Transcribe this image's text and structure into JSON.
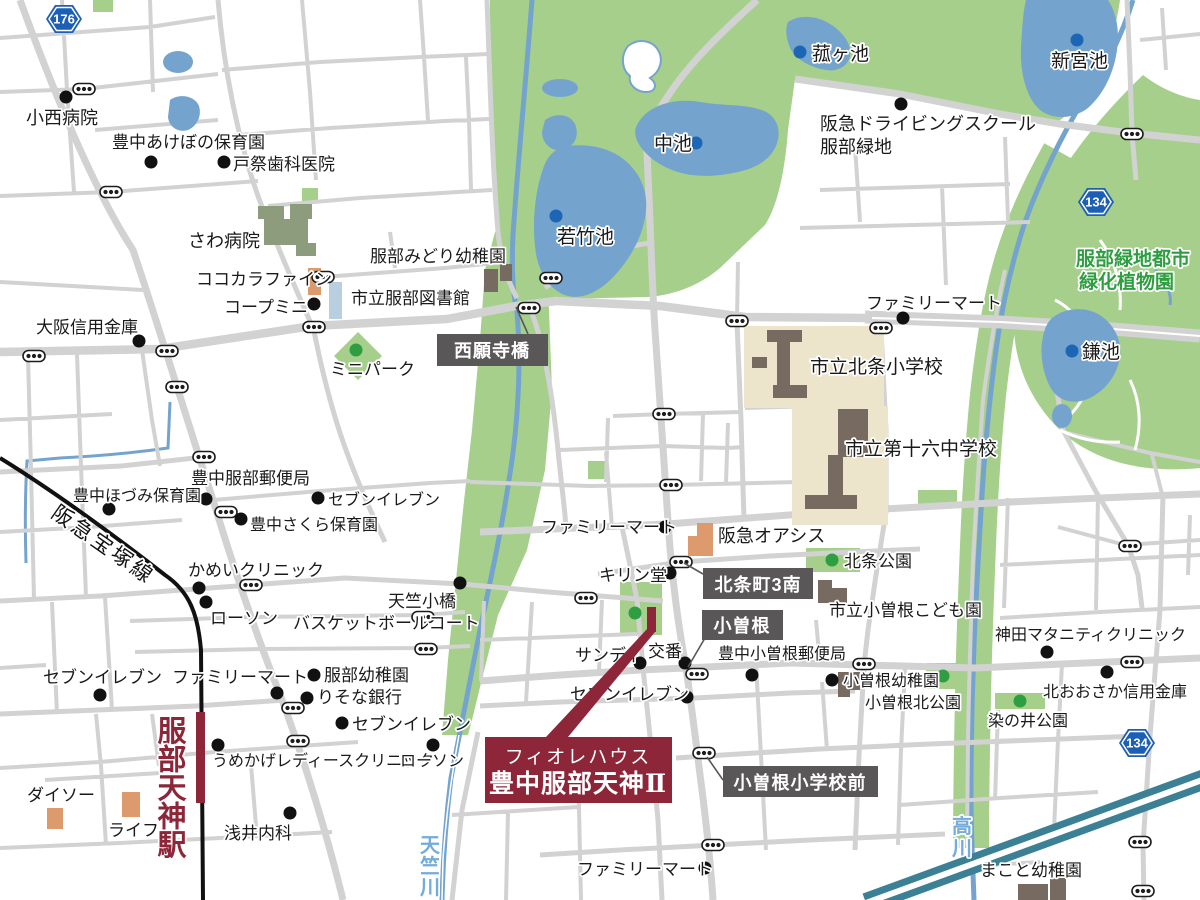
{
  "map": {
    "site": {
      "line1": "フィオレハウス",
      "line2": "豊中服部天神Ⅱ"
    },
    "station": {
      "name": "服部天神駅"
    },
    "railway": {
      "name": "阪急宝塚線"
    },
    "rivers": [
      {
        "name": "天竺川"
      },
      {
        "name": "高川"
      }
    ],
    "garden": {
      "line1": "服部緑地都市",
      "line2": "緑化植物園"
    },
    "callouts": [
      {
        "t": "西願寺橋"
      },
      {
        "t": "北条町3南"
      },
      {
        "t": "小曽根"
      },
      {
        "t": "小曽根小学校前"
      }
    ],
    "route_badges": [
      {
        "n": "176",
        "x": 64,
        "y": 19
      },
      {
        "n": "134",
        "x": 1096,
        "y": 202
      },
      {
        "n": "134",
        "x": 1137,
        "y": 743
      }
    ],
    "colors": {
      "accent_maroon": "#8c2638",
      "callout_gray": "#595757",
      "park_green": "#a6cf8c",
      "water_blue": "#74a4ce",
      "road_gray": "#d2d2d2",
      "badge_blue": "#1d5fb4",
      "garden_text_green": "#2f9e41",
      "river_text_blue": "#74abd8"
    },
    "labels": [
      {
        "t": "小西病院",
        "x": 26,
        "y": 124,
        "s": 18
      },
      {
        "t": "豊中あけぼの保育園",
        "x": 112,
        "y": 148
      },
      {
        "t": "戸祭歯科医院",
        "x": 233,
        "y": 170
      },
      {
        "t": "さわ病院",
        "x": 188,
        "y": 247,
        "s": 18
      },
      {
        "t": "ココカラファイン",
        "x": 196,
        "y": 285
      },
      {
        "t": "コープミニ",
        "x": 224,
        "y": 313
      },
      {
        "t": "市立服部図書館",
        "x": 351,
        "y": 304
      },
      {
        "t": "大阪信用金庫",
        "x": 36,
        "y": 333
      },
      {
        "t": "ミニパーク",
        "x": 330,
        "y": 375
      },
      {
        "t": "服部みどり幼稚園",
        "x": 370,
        "y": 262
      },
      {
        "t": "豊中服部郵便局",
        "x": 191,
        "y": 484
      },
      {
        "t": "豊中ほづみ保育園",
        "x": 73,
        "y": 501,
        "s": 16
      },
      {
        "t": "セブンイレブン",
        "x": 328,
        "y": 505,
        "s": 16
      },
      {
        "t": "豊中さくら保育園",
        "x": 250,
        "y": 530,
        "s": 16
      },
      {
        "t": "かめいクリニック",
        "x": 188,
        "y": 576
      },
      {
        "t": "ローソン",
        "x": 210,
        "y": 624
      },
      {
        "t": "天竺小橋",
        "x": 388,
        "y": 607
      },
      {
        "t": "バスケットボールコート",
        "x": 293,
        "y": 629
      },
      {
        "t": "セブンイレブン",
        "x": 43,
        "y": 683
      },
      {
        "t": "ファミリーマート",
        "x": 172,
        "y": 683
      },
      {
        "t": "服部幼稚園",
        "x": 324,
        "y": 681
      },
      {
        "t": "りそな銀行",
        "x": 317,
        "y": 703
      },
      {
        "t": "セブンイレブン",
        "x": 352,
        "y": 730
      },
      {
        "t": "うめかげレディースクリニック",
        "x": 212,
        "y": 766,
        "s": 16
      },
      {
        "t": "ローソン",
        "x": 400,
        "y": 766,
        "s": 16
      },
      {
        "t": "ダイソー",
        "x": 27,
        "y": 801
      },
      {
        "t": "ライフ",
        "x": 108,
        "y": 836
      },
      {
        "t": "浅井内科",
        "x": 224,
        "y": 839
      },
      {
        "t": "サンディ",
        "x": 575,
        "y": 661
      },
      {
        "t": "交番",
        "x": 648,
        "y": 657
      },
      {
        "t": "セブンイレブン",
        "x": 570,
        "y": 700
      },
      {
        "t": "キリン堂",
        "x": 599,
        "y": 581
      },
      {
        "t": "ファミリーマート",
        "x": 541,
        "y": 533
      },
      {
        "t": "阪急オアシス",
        "x": 718,
        "y": 542,
        "s": 18
      },
      {
        "t": "ファミリーマート",
        "x": 577,
        "y": 875
      },
      {
        "t": "豊中小曽根郵便局",
        "x": 718,
        "y": 659,
        "s": 16
      },
      {
        "t": "小曽根幼稚園",
        "x": 843,
        "y": 686,
        "s": 16
      },
      {
        "t": "小曽根北公園",
        "x": 865,
        "y": 708,
        "s": 16
      },
      {
        "t": "染の井公園",
        "x": 988,
        "y": 726,
        "s": 16
      },
      {
        "t": "北おおさか信用金庫",
        "x": 1043,
        "y": 697,
        "s": 16
      },
      {
        "t": "神田マタニティクリニック",
        "x": 995,
        "y": 640,
        "s": 16
      },
      {
        "t": "市立小曽根こども園",
        "x": 829,
        "y": 616
      },
      {
        "t": "北条公園",
        "x": 844,
        "y": 567
      },
      {
        "t": "市立北条小学校",
        "x": 810,
        "y": 373,
        "s": 19
      },
      {
        "t": "市立第十六中学校",
        "x": 845,
        "y": 455,
        "s": 19
      },
      {
        "t": "ファミリーマート",
        "x": 866,
        "y": 309
      },
      {
        "t": "阪急ドライビングスクール",
        "x": 820,
        "y": 130,
        "s": 18
      },
      {
        "t": "服部緑地",
        "x": 820,
        "y": 153,
        "s": 18
      },
      {
        "t": "菰ヶ池",
        "x": 812,
        "y": 60,
        "s": 19
      },
      {
        "t": "中池",
        "x": 654,
        "y": 150,
        "s": 19
      },
      {
        "t": "若竹池",
        "x": 557,
        "y": 243,
        "s": 19
      },
      {
        "t": "新宮池",
        "x": 1051,
        "y": 67,
        "s": 19
      },
      {
        "t": "鎌池",
        "x": 1082,
        "y": 358,
        "s": 19
      },
      {
        "t": "まこと幼稚園",
        "x": 980,
        "y": 876
      },
      {
        "t": "服部緑地都市",
        "x": 1076,
        "y": 265,
        "s": 19,
        "c": "green-t"
      },
      {
        "t": "緑化植物園",
        "x": 1079,
        "y": 288,
        "s": 19,
        "c": "green-t"
      },
      {
        "t": "天竺川",
        "x": 430,
        "y": 852,
        "s": 20,
        "c": "blue-t",
        "v": 21
      },
      {
        "t": "高川",
        "x": 962,
        "y": 833,
        "s": 20,
        "c": "blue-t",
        "v": 22
      },
      {
        "t": "服部天神駅",
        "x": 172,
        "y": 741,
        "s": 29,
        "c": "station-t",
        "v": 28.5
      },
      {
        "t": "阪急宝塚線",
        "x": 50,
        "y": 516,
        "s": 21,
        "c": "rail-t",
        "r": 35,
        "ls": 3
      }
    ],
    "poi_dots": [
      [
        66,
        97
      ],
      [
        151,
        162
      ],
      [
        224,
        162
      ],
      [
        314,
        304
      ],
      [
        139,
        341
      ],
      [
        206,
        499
      ],
      [
        109,
        509
      ],
      [
        318,
        498
      ],
      [
        241,
        519
      ],
      [
        199,
        588
      ],
      [
        206,
        602
      ],
      [
        460,
        583
      ],
      [
        100,
        695
      ],
      [
        277,
        693
      ],
      [
        314,
        675
      ],
      [
        307,
        698
      ],
      [
        342,
        723
      ],
      [
        218,
        745
      ],
      [
        433,
        745
      ],
      [
        290,
        813
      ],
      [
        705,
        868
      ],
      [
        640,
        663
      ],
      [
        685,
        663
      ],
      [
        687,
        697
      ],
      [
        670,
        573
      ],
      [
        665,
        527
      ],
      [
        752,
        675
      ],
      [
        832,
        680
      ],
      [
        1107,
        672
      ],
      [
        1047,
        652
      ],
      [
        903,
        318
      ],
      [
        901,
        104
      ]
    ],
    "green_dots": [
      [
        356,
        350
      ],
      [
        635,
        613
      ],
      [
        832,
        560
      ],
      [
        943,
        676
      ],
      [
        1020,
        701
      ]
    ],
    "blue_dots": [
      [
        800,
        52
      ],
      [
        696,
        143
      ],
      [
        556,
        216
      ],
      [
        1077,
        40
      ],
      [
        1072,
        351
      ]
    ],
    "signals": [
      [
        84,
        89
      ],
      [
        111,
        192
      ],
      [
        323,
        277
      ],
      [
        314,
        327
      ],
      [
        34,
        356
      ],
      [
        167,
        351
      ],
      [
        177,
        387
      ],
      [
        204,
        457
      ],
      [
        226,
        512
      ],
      [
        251,
        585
      ],
      [
        423,
        617
      ],
      [
        426,
        649
      ],
      [
        293,
        708
      ],
      [
        298,
        741
      ],
      [
        551,
        278
      ],
      [
        529,
        308
      ],
      [
        664,
        414
      ],
      [
        671,
        485
      ],
      [
        681,
        562
      ],
      [
        586,
        598
      ],
      [
        697,
        674
      ],
      [
        864,
        664
      ],
      [
        704,
        753
      ],
      [
        713,
        845
      ],
      [
        737,
        321
      ],
      [
        881,
        328
      ],
      [
        1132,
        134
      ],
      [
        1132,
        662
      ],
      [
        1130,
        546
      ],
      [
        1140,
        842
      ],
      [
        1143,
        891
      ]
    ]
  }
}
